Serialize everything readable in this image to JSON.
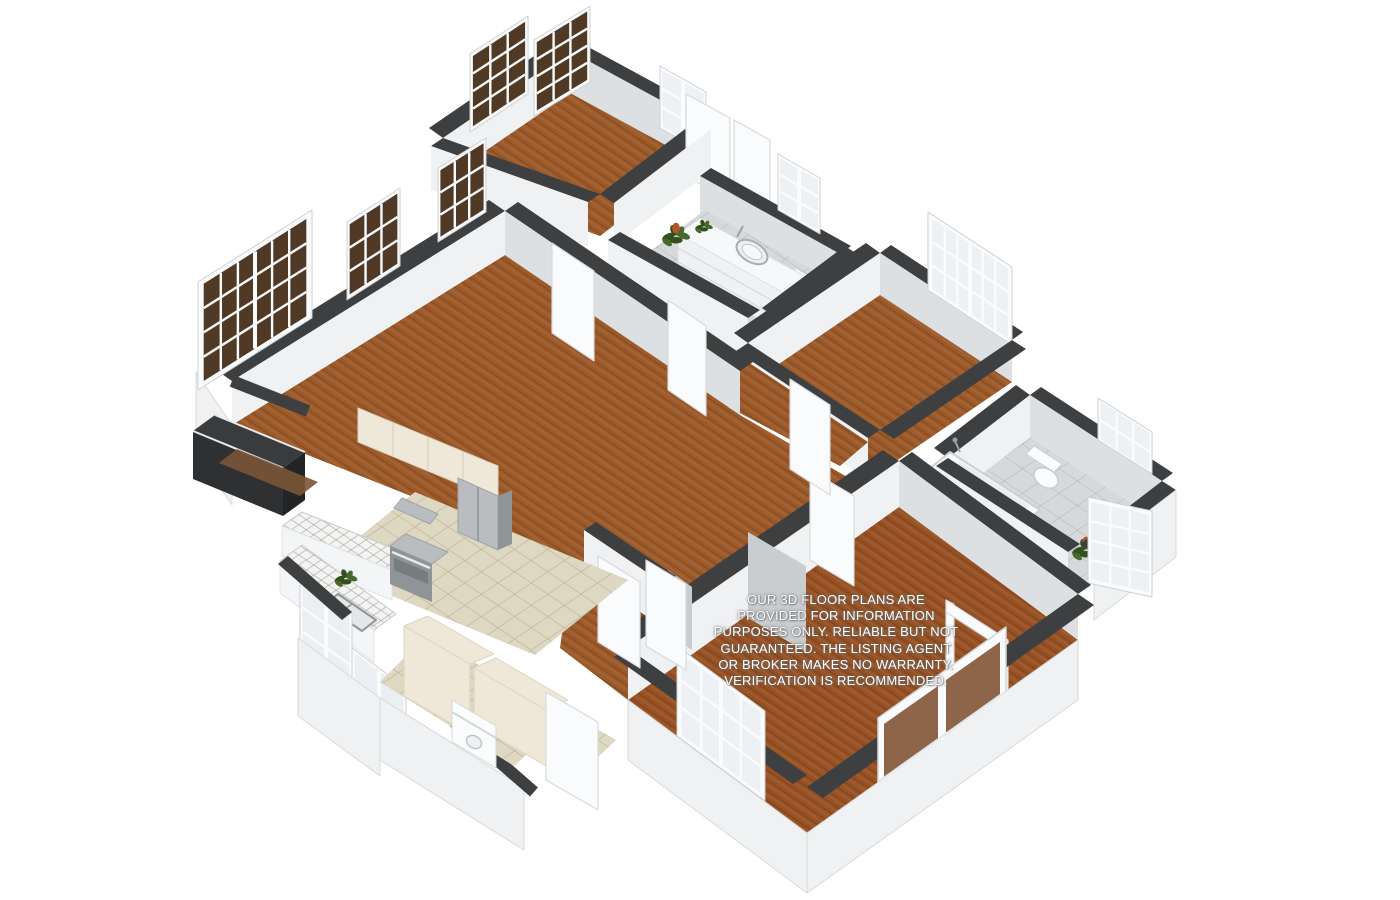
{
  "disclaimer": {
    "text": "OUR 3D FLOOR PLANS ARE\nPROVIDED FOR INFORMATION\nPURPOSES ONLY. RELIABLE BUT NOT\nGUARANTEED. THE LISTING AGENT\nOR BROKER MAKES NO WARRANTY.\nVERIFICATION IS RECOMMENDED.",
    "text_color": "#ffffff",
    "halo_color": "#6e6e6e"
  },
  "palette": {
    "background": "#ffffff",
    "wood_floor": "#9c5a2a",
    "wood_floor_master": "#975124",
    "wood_plank_line": "rgba(74,38,12,0.35)",
    "wall_top": "#3e3f41",
    "wall_face_light": "#f0f1f2",
    "wall_face_shaded": "#dde0e2",
    "wall_edge": "#d8dadb",
    "tile_gray": "#d6d8d9",
    "tile_beige": "#ded7c2",
    "counter_tile": "#f3f3f1",
    "cabinet_cream": "#efe8d8",
    "appliance_steel": "#b9bdbf",
    "appliance_steel_dark": "#8f9496",
    "window_frame": "#fafbfc",
    "window_pane_dark": "#503a25",
    "window_pane_light": "#eef1f3",
    "glass_tint": "rgba(205,215,220,0.5)",
    "plant_green": "#47692e",
    "plant_green_dark": "#33511e",
    "plant_bloom": "#b05a23",
    "fireplace_dark": "#2f3032",
    "hearth_brown": "#7a5536"
  },
  "scene": {
    "type": "3d-floor-plan",
    "rooms": [
      {
        "name": "bedroom-top",
        "floor": "wood"
      },
      {
        "name": "hall-bathroom",
        "floor": "gray-tile",
        "fixtures": [
          "vanity-sink",
          "shower",
          "plants",
          "window"
        ]
      },
      {
        "name": "bedroom-middle",
        "floor": "wood",
        "fixtures": [
          "double-window"
        ]
      },
      {
        "name": "bathroom-rear",
        "floor": "gray-tile",
        "fixtures": [
          "bathtub",
          "toilet",
          "shower-door",
          "plant",
          "windows"
        ]
      },
      {
        "name": "living-room",
        "floor": "wood",
        "fixtures": [
          "fireplace",
          "picture-windows"
        ]
      },
      {
        "name": "hallway",
        "floor": "wood",
        "fixtures": [
          "doors",
          "closets"
        ]
      },
      {
        "name": "kitchen",
        "floor": "beige-tile",
        "fixtures": [
          "range-hood",
          "stove",
          "refrigerator",
          "tile-counters",
          "sink",
          "corner-windows",
          "plant"
        ]
      },
      {
        "name": "laundry-entry",
        "floor": "beige-tile",
        "fixtures": [
          "cabinets",
          "washer",
          "back-door"
        ]
      },
      {
        "name": "master-bedroom",
        "floor": "wood",
        "fixtures": [
          "sliding-glass-door",
          "double-window",
          "door-frame"
        ]
      }
    ]
  }
}
